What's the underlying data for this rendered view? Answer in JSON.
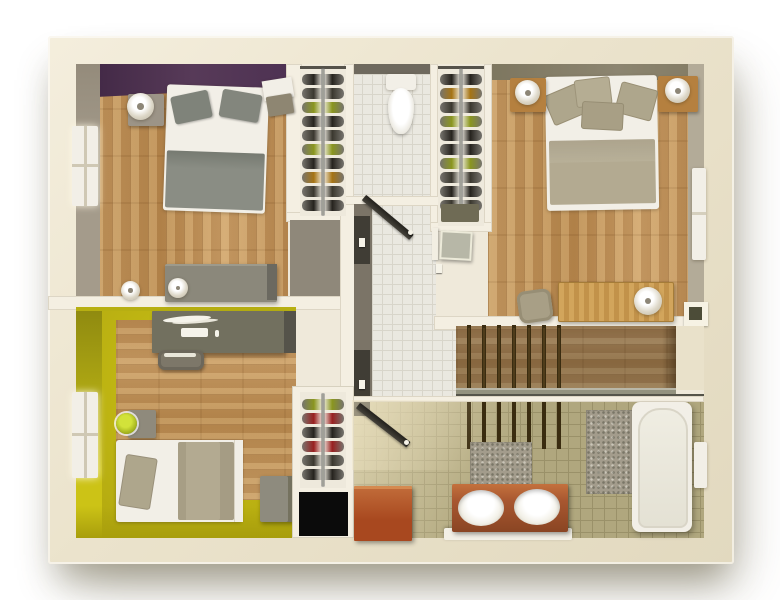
{
  "title": "floor-plan-3d-top-view",
  "colors": {
    "background": "#ffffff",
    "outer_wall": "#ebe3cc",
    "wall_white": "#f4efe2",
    "wood_floor": "#c49a62",
    "stairs_wood": "#97723f",
    "purple_wall": "#573a58",
    "purple_wall_dark": "#3f2643",
    "gray_wall": "#a49b8b",
    "olive_wall": "#8c8570",
    "taupe_wall": "#7b7467",
    "yellow_wall": "#b0a80f",
    "yellow_floor": "#ccc316",
    "tile_white": "#eae8e0",
    "tile_grid": "#d8d5ca",
    "bath_tile": "#b0a77e",
    "door_dark": "#45423a",
    "black_void": "#0b0b0b",
    "wine_dark": "#26231e",
    "wine_dark2": "#3b382f",
    "wine_green": "#8a961f",
    "wine_amber": "#a67414",
    "wine_red": "#992020",
    "cherry_wood": "#a8481f",
    "vanity_wood": "#a85730",
    "mat_gray": "#a39c8c",
    "bed_white": "#f2efe7",
    "blanket_gray": "#8a8d84",
    "blanket_taupe": "#b3aa91",
    "pillow_gray": "#7f837a",
    "pillow_taupe": "#aea68c",
    "desk_gray": "#72705f",
    "dresser_gray": "#8b887b",
    "lamp_green": "#9fae1c",
    "metal_rail": "#a0a098",
    "sage_door": "#b7b7a7",
    "ledge_white": "#f3f0e6"
  },
  "scene": {
    "view": "top-down 3d dollhouse floor plan, no visible text",
    "rooms": [
      {
        "name": "bedroom-master",
        "position": "top-left",
        "walls": [
          "purple_wall",
          "gray_wall"
        ],
        "floor": "wood",
        "furniture": [
          "double-bed",
          "gray-pillows",
          "nightstand-left-with-lamp",
          "nightstand-right-with-lamp",
          "dresser-with-lamp",
          "cup",
          "window-left"
        ]
      },
      {
        "name": "closet-wine-rack-1",
        "position": "top-middle-left",
        "floor": "white",
        "furniture": [
          "wine-bottle-rack",
          "metal-rail"
        ]
      },
      {
        "name": "wc",
        "position": "top-middle",
        "floor": "white-tile",
        "furniture": [
          "toilet-with-cistern"
        ]
      },
      {
        "name": "closet-wine-rack-2",
        "position": "top-middle-right",
        "floor": "white",
        "furniture": [
          "wine-bottle-rack",
          "metal-rail",
          "small-cabinet"
        ]
      },
      {
        "name": "bedroom-second",
        "position": "top-right",
        "walls": [
          "olive_wall"
        ],
        "floor": "wood",
        "furniture": [
          "double-bed",
          "taupe-pillows",
          "nightstand-left-with-lamp",
          "nightstand-right-with-lamp",
          "desk-wood-with-lamp",
          "chair",
          "window-right",
          "wall-niche"
        ]
      },
      {
        "name": "hallway-landing",
        "position": "center",
        "floor": "white-tile",
        "furniture": [
          "open-door-wc",
          "open-door-bedroom2",
          "sage-folding-door",
          "door-handles"
        ]
      },
      {
        "name": "staircase",
        "position": "center-right",
        "floor": "dark-wood",
        "furniture": [
          "stair-treads",
          "edge-strip"
        ]
      },
      {
        "name": "office-kid-room",
        "position": "bottom-left",
        "walls": [
          "yellow_wall"
        ],
        "floor": "yellow-with-wood-panel",
        "furniture": [
          "desk-gray-with-laptop",
          "desk-chair",
          "nightstand-with-green-lamp",
          "single-bed",
          "storage-box",
          "window-left"
        ]
      },
      {
        "name": "closet-wine-rack-3",
        "position": "bottom-middle",
        "floor": "white",
        "furniture": [
          "wine-bottle-rack",
          "black-void"
        ]
      },
      {
        "name": "bathroom",
        "position": "bottom-right",
        "floor": "olive-tile",
        "furniture": [
          "open-door",
          "cherry-box",
          "double-sink-vanity",
          "white-ledge",
          "bath-mats",
          "bathtub",
          "window-right"
        ]
      }
    ],
    "closets": [
      {
        "id": "closet1",
        "bottle_colors": [
          "wine_dark",
          "wine_dark2",
          "wine_green",
          "wine_dark",
          "wine_dark2",
          "wine_green",
          "wine_dark",
          "wine_amber",
          "wine_dark2",
          "wine_dark"
        ]
      },
      {
        "id": "closet2",
        "bottle_colors": [
          "wine_dark",
          "wine_amber",
          "wine_dark2",
          "wine_green",
          "wine_dark",
          "wine_dark",
          "wine_green",
          "wine_dark2",
          "wine_dark",
          "wine_dark2"
        ]
      },
      {
        "id": "closet3",
        "bottle_colors": [
          "wine_green",
          "wine_red",
          "wine_dark",
          "wine_red",
          "wine_dark2",
          "wine_dark"
        ]
      }
    ],
    "stairs": {
      "tread_count": 7
    }
  }
}
